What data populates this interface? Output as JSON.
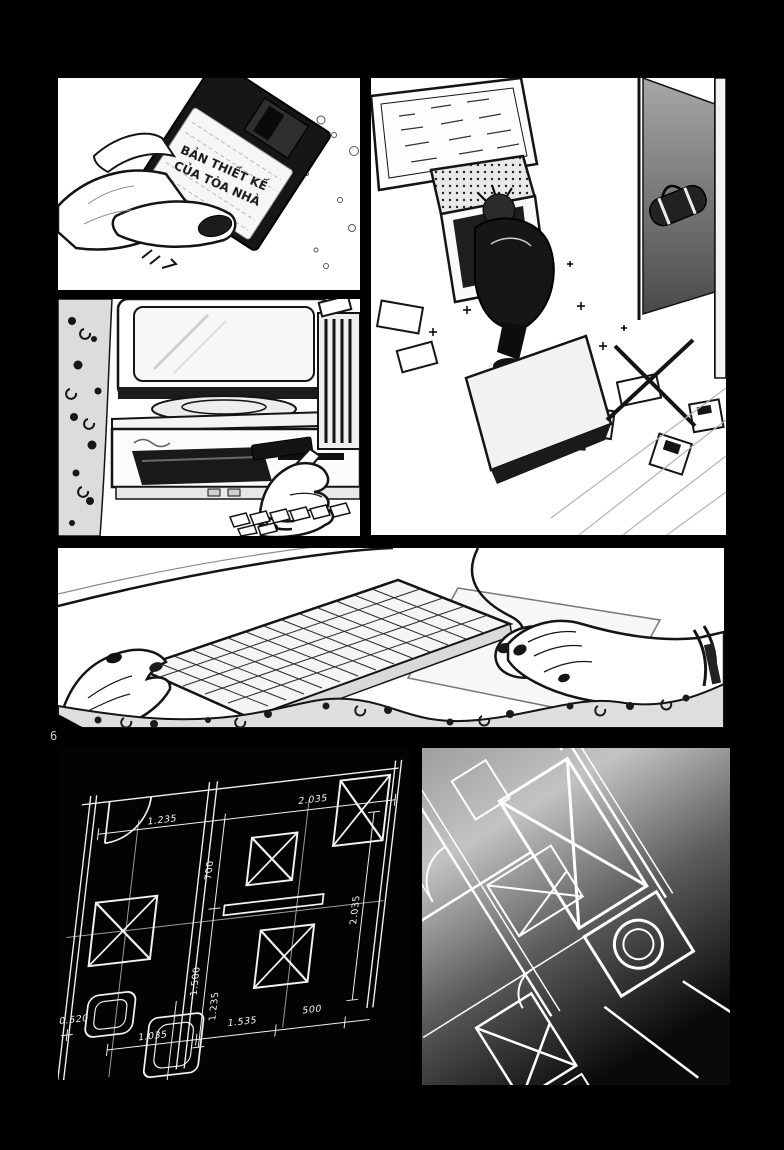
{
  "page": {
    "number": "6"
  },
  "floppy_panel": {
    "disk_label_line1": "BẢN THIẾT KẾ",
    "disk_label_line2": "CỦA TÒA NHÀ"
  },
  "blueprint_panel": {
    "dim_top_1": "1.235",
    "dim_top_2": "2.035",
    "dim_mid_vert_1": "700",
    "dim_mid_vert_2": "1.500",
    "dim_right_vert": "2.035",
    "dim_left": "20.520",
    "dim_bottom_vert": "1.235",
    "dim_bottom_1": "1.035",
    "dim_bottom_2": "1.535",
    "dim_bottom_3": "500"
  },
  "colors": {
    "page_background": "#000000",
    "panel_background": "#ffffff",
    "ink": "#141414",
    "blueprint_line": "#f2f2f2"
  }
}
